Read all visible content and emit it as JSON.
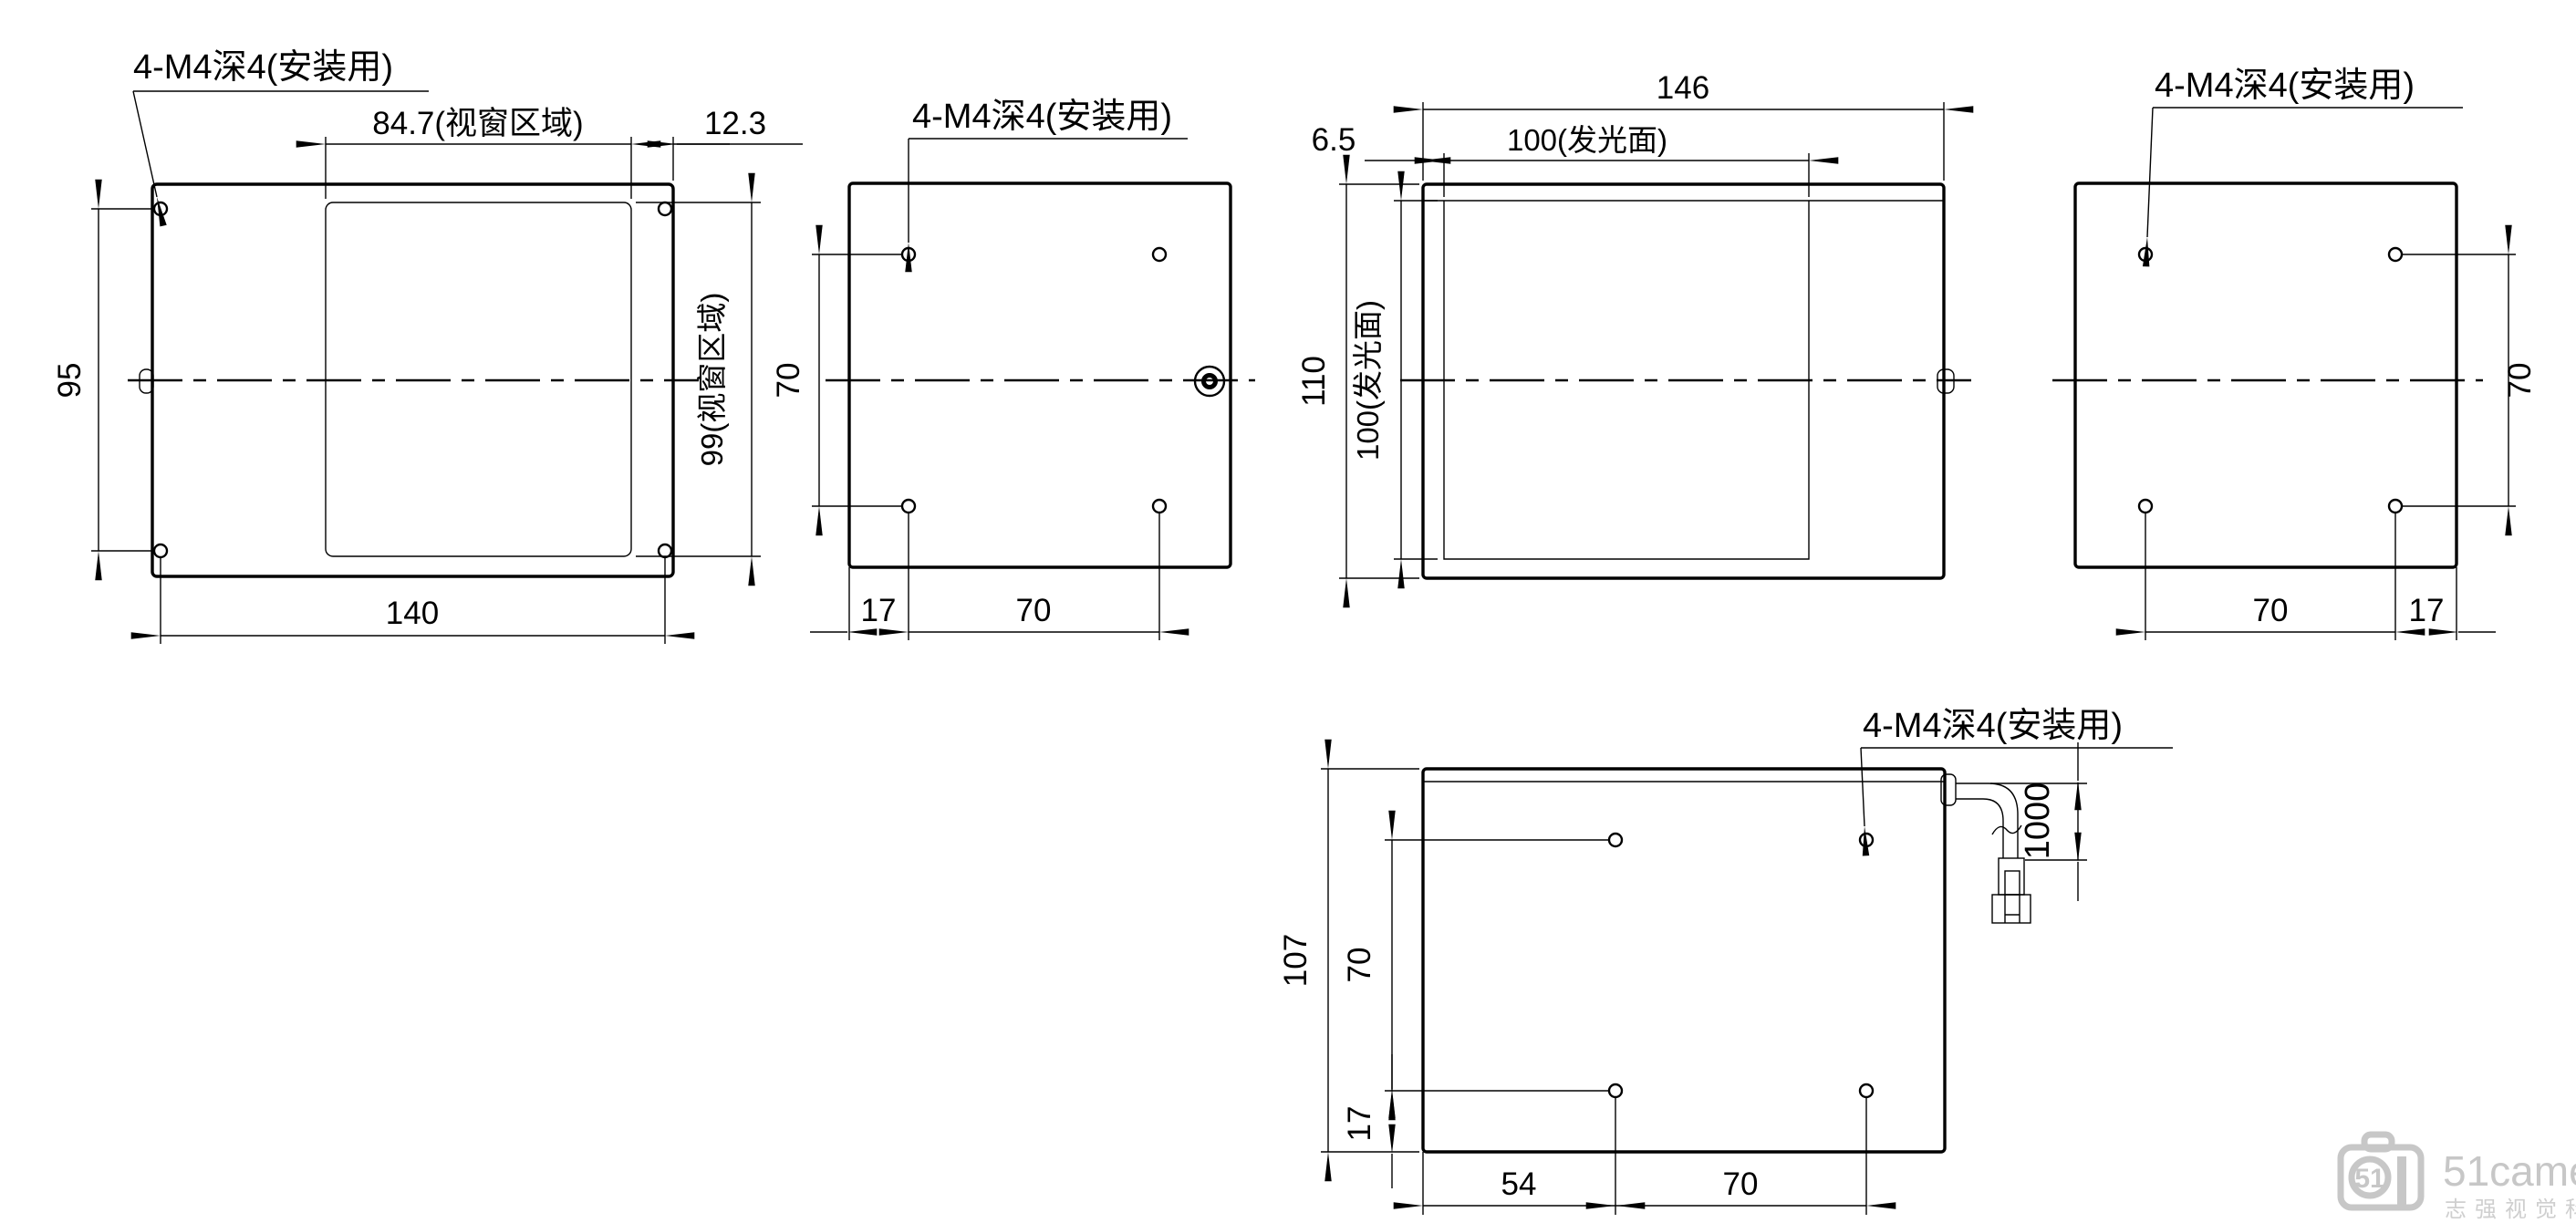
{
  "drawing": {
    "title_note": "4-M4深4(安装用)",
    "views": {
      "front_a": {
        "label": "4-M4深4(安装用)",
        "dim_window_w": "84.7(视窗区域)",
        "dim_margin_r": "12.3",
        "dim_hole_spacing_v": "95",
        "dim_width": "140",
        "dim_window_h": "99(视窗区域)"
      },
      "back_a": {
        "label": "4-M4深4(安装用)",
        "dim_hole_spacing_v": "70",
        "dim_edge": "17",
        "dim_hole_spacing_h": "70"
      },
      "front_b": {
        "dim_width": "146",
        "dim_glow_w": "100(发光面)",
        "dim_offset": "6.5",
        "dim_height": "110",
        "dim_glow_h": "100(发光面)"
      },
      "back_b": {
        "label": "4-M4深4(安装用)",
        "dim_hole_spacing_v": "70",
        "dim_hole_spacing_h": "70",
        "dim_edge": "17"
      },
      "bottom": {
        "label": "4-M4深4(安装用)",
        "dim_height": "107",
        "dim_hole_spacing_v": "70",
        "dim_edge_b": "17",
        "dim_left": "54",
        "dim_hole_spacing_h": "70",
        "dim_cable": "1000"
      }
    },
    "watermark": {
      "logo": "51",
      "brand": "51camera",
      "sub": "志强视觉科技"
    }
  }
}
